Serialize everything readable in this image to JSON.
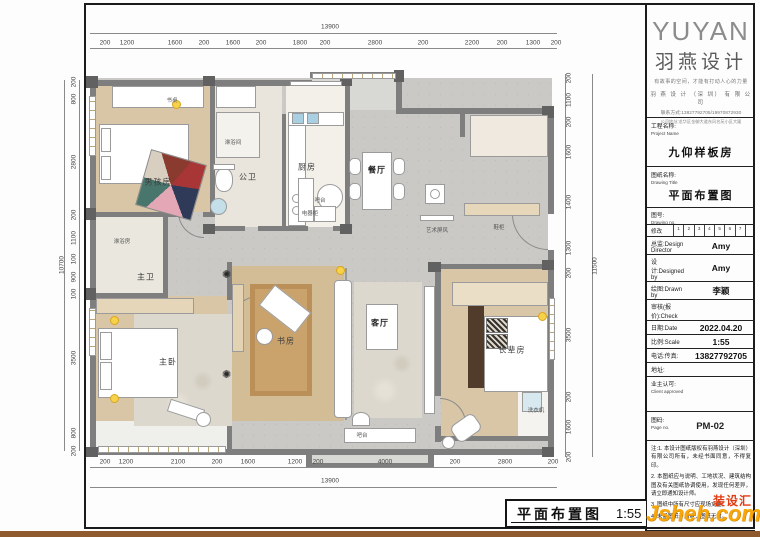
{
  "logo": {
    "brand_en": "YUYAN",
    "brand_cn": "羽燕设计",
    "slogan": "有故事的空间，才能有打动人心的力量",
    "company": "羽 燕 设 计 （深 圳） 有 限 公 司",
    "contact": "联系方式:13827792705/19970872930",
    "address": "公司地址:龙华区金御大道东风名苑小区大厦"
  },
  "title_block": {
    "project_label": "工程名称:",
    "project_label_en": "Project Name",
    "project_value": "九仰样板房",
    "drawing_label": "图纸名称:",
    "drawing_label_en": "Drawing Title",
    "drawing_value": "平面布置图",
    "drawing_no_label": "图号:",
    "drawing_no_label_en": "Drawing no.",
    "revision_label": "修改",
    "revision_cells": [
      "1",
      "2",
      "3",
      "4",
      "5",
      "6",
      "7",
      ""
    ],
    "rows": [
      {
        "cn": "总监:",
        "en": "Design Director",
        "value": "Amy"
      },
      {
        "cn": "设计:",
        "en": "Designed by",
        "value": "Amy"
      },
      {
        "cn": "绘图:",
        "en": "Drawn by",
        "value": "李颖"
      },
      {
        "cn": "审核(报价):",
        "en": "Check",
        "value": ""
      },
      {
        "cn": "日期:",
        "en": "Date",
        "value": "2022.04.20"
      },
      {
        "cn": "比例:",
        "en": "Scale",
        "value": "1:55"
      },
      {
        "cn": "电话:",
        "en": "传真:",
        "value": "13827792705"
      },
      {
        "cn": "地址:",
        "en": "",
        "value": ""
      }
    ],
    "client_label": "业主认可:",
    "client_label_en": "Client approved",
    "page_label": "图码:",
    "page_label_en": "Page no.",
    "page_value": "PM-02",
    "notes": [
      "注:1. 本设计图纸版权有羽燕设计（深圳）有限公司所有，未经书面同意，不得复印。",
      "2. 本图纸应与说明、工地状况、建筑结构图及有关图纸协调使用，发现任何差异，请立即通知设计师。",
      "3. 图纸中所有尺寸应现场丈量。",
      "4. 未盖图纸专用章，图纸无效。"
    ]
  },
  "plan": {
    "rooms": [
      {
        "t": "书桌",
        "x": 172,
        "y": 100,
        "s": "xs"
      },
      {
        "t": "男孩房",
        "x": 158,
        "y": 182,
        "s": "md"
      },
      {
        "t": "淋浴间",
        "x": 233,
        "y": 142,
        "s": "xs"
      },
      {
        "t": "公卫",
        "x": 248,
        "y": 177,
        "s": "md"
      },
      {
        "t": "厨房",
        "x": 307,
        "y": 167,
        "s": "md"
      },
      {
        "t": "电器柜",
        "x": 310,
        "y": 213,
        "s": "xs"
      },
      {
        "t": "餐厅",
        "x": 377,
        "y": 170,
        "s": "md",
        "b": true
      },
      {
        "t": "吧台",
        "x": 320,
        "y": 200,
        "s": "xs"
      },
      {
        "t": "艺术屏风",
        "x": 437,
        "y": 230,
        "s": "xs"
      },
      {
        "t": "鞋柜",
        "x": 499,
        "y": 227,
        "s": "xs"
      },
      {
        "t": "淋浴房",
        "x": 122,
        "y": 241,
        "s": "xs"
      },
      {
        "t": "主卫",
        "x": 146,
        "y": 277,
        "s": "md"
      },
      {
        "t": "主卧",
        "x": 168,
        "y": 362,
        "s": "md"
      },
      {
        "t": "书房",
        "x": 286,
        "y": 341,
        "s": "md"
      },
      {
        "t": "客厅",
        "x": 380,
        "y": 323,
        "s": "md",
        "b": true
      },
      {
        "t": "长辈房",
        "x": 512,
        "y": 350,
        "s": "md"
      },
      {
        "t": "吧台",
        "x": 362,
        "y": 435,
        "s": "xs"
      },
      {
        "t": "洗衣机",
        "x": 536,
        "y": 410,
        "s": "xs"
      }
    ],
    "dims": {
      "top": {
        "total": "13900",
        "labels": [
          {
            "t": "200",
            "x": 105
          },
          {
            "t": "1200",
            "x": 127
          },
          {
            "t": "1600",
            "x": 175
          },
          {
            "t": "200",
            "x": 204
          },
          {
            "t": "1600",
            "x": 233
          },
          {
            "t": "200",
            "x": 261
          },
          {
            "t": "1800",
            "x": 300
          },
          {
            "t": "200",
            "x": 325
          },
          {
            "t": "2800",
            "x": 375
          },
          {
            "t": "200",
            "x": 423
          },
          {
            "t": "2200",
            "x": 472
          },
          {
            "t": "200",
            "x": 502
          },
          {
            "t": "1300",
            "x": 533
          },
          {
            "t": "200",
            "x": 556
          }
        ]
      },
      "bottom": {
        "total": "13900",
        "labels": [
          {
            "t": "200",
            "x": 105
          },
          {
            "t": "1200",
            "x": 126
          },
          {
            "t": "2100",
            "x": 178
          },
          {
            "t": "200",
            "x": 217
          },
          {
            "t": "1600",
            "x": 248
          },
          {
            "t": "1200",
            "x": 295
          },
          {
            "t": "200",
            "x": 318
          },
          {
            "t": "4000",
            "x": 385
          },
          {
            "t": "200",
            "x": 455
          },
          {
            "t": "2800",
            "x": 505
          },
          {
            "t": "200",
            "x": 553
          }
        ]
      },
      "left": {
        "total": "10700",
        "labels": [
          {
            "t": "200",
            "y": 82
          },
          {
            "t": "800",
            "y": 99
          },
          {
            "t": "2800",
            "y": 162
          },
          {
            "t": "200",
            "y": 215
          },
          {
            "t": "1100",
            "y": 238
          },
          {
            "t": "100",
            "y": 259
          },
          {
            "t": "900",
            "y": 277
          },
          {
            "t": "100",
            "y": 294
          },
          {
            "t": "3500",
            "y": 358
          },
          {
            "t": "800",
            "y": 433
          },
          {
            "t": "200",
            "y": 451
          }
        ]
      },
      "right": {
        "total": "11500",
        "labels": [
          {
            "t": "200",
            "y": 78
          },
          {
            "t": "1100",
            "y": 100
          },
          {
            "t": "200",
            "y": 122
          },
          {
            "t": "1600",
            "y": 152
          },
          {
            "t": "1400",
            "y": 202
          },
          {
            "t": "1300",
            "y": 248
          },
          {
            "t": "200",
            "y": 273
          },
          {
            "t": "3500",
            "y": 335
          },
          {
            "t": "200",
            "y": 397
          },
          {
            "t": "1600",
            "y": 427
          },
          {
            "t": "200",
            "y": 457
          }
        ]
      }
    }
  },
  "footer": {
    "title": "平面布置图",
    "scale": "1:55"
  },
  "watermark": {
    "site": "Jsheh.com",
    "cn": "装设汇"
  }
}
